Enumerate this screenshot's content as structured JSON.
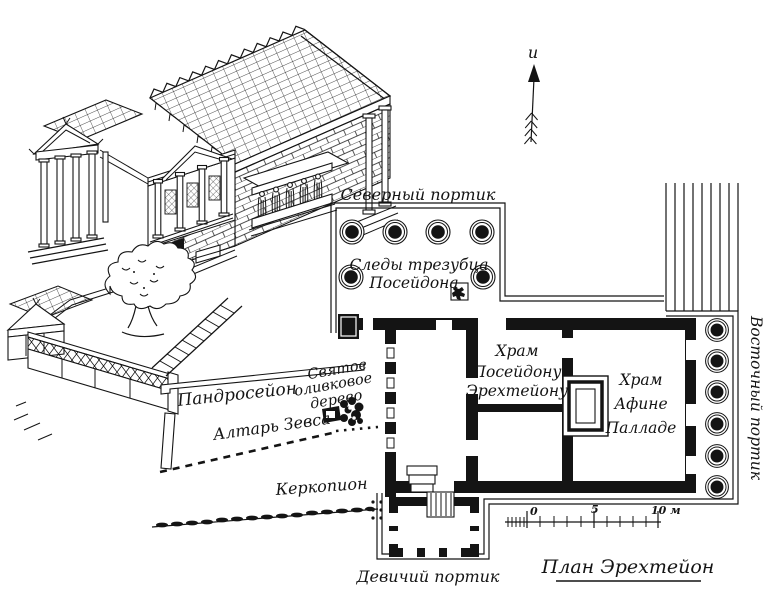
{
  "figure": {
    "colors": {
      "ink": "#141414",
      "paper": "#ffffff"
    },
    "north_arrow_letter": "и"
  },
  "plan": {
    "title": "План Эрехтейон",
    "labels": {
      "north_portico": "Северный портик",
      "trident_1": "Следы трезубца",
      "trident_2": "Посейдона",
      "poseidon_1": "Храм",
      "poseidon_2": "Посейдону",
      "poseidon_3": "Эрехтейону",
      "athena_1": "Храм",
      "athena_2": "Афине",
      "athena_3": "Палладе",
      "east_portico": "Восточный портик",
      "maiden_portico": "Девичий портик",
      "pandroseion": "Пандросейон",
      "olive_1": "Святое",
      "olive_2": "оливковое",
      "olive_3": "дерево",
      "zeus_altar": "Алтарь Зевса",
      "kekropion": "Керкопион"
    },
    "scale_bar": {
      "start": "0",
      "middle": "5",
      "end": "10 м"
    }
  }
}
